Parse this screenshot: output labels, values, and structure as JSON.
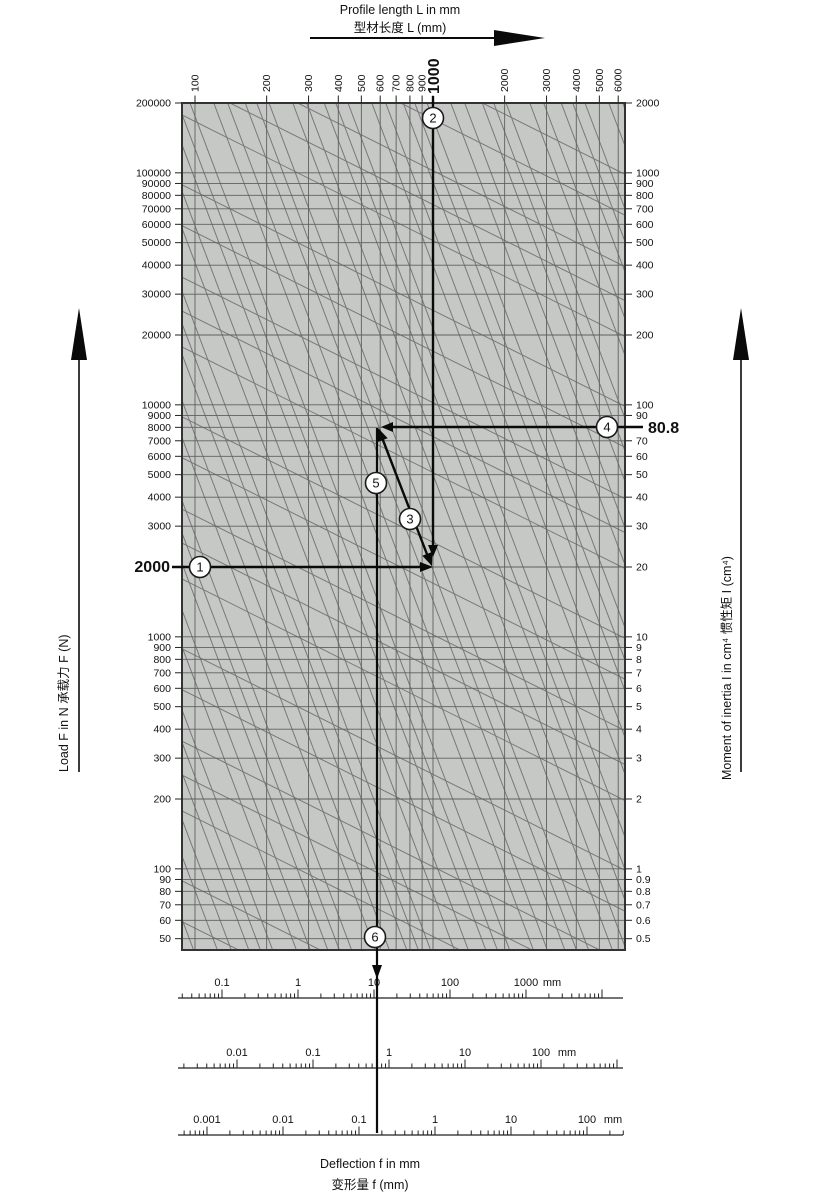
{
  "chart_data": {
    "type": "nomogram",
    "title": {
      "line1": "Profile length L in mm",
      "line2": "型材长度 L (mm)"
    },
    "x_axis": {
      "unit": "mm",
      "ticks": [
        "100",
        "200",
        "300",
        "400",
        "500",
        "600",
        "700",
        "800",
        "900",
        "1000",
        "2000",
        "3000",
        "4000",
        "5000",
        "6000"
      ],
      "bold_tick": "1000"
    },
    "left_axis": {
      "label": "Load F in N   承载力 F (N)",
      "unit": "N",
      "ticks": [
        "200000",
        "100000",
        "90000",
        "80000",
        "70000",
        "60000",
        "50000",
        "40000",
        "30000",
        "20000",
        "10000",
        "9000",
        "8000",
        "7000",
        "6000",
        "5000",
        "4000",
        "3000",
        "2000",
        "1000",
        "900",
        "800",
        "700",
        "600",
        "500",
        "400",
        "300",
        "200",
        "100",
        "90",
        "80",
        "70",
        "60",
        "50"
      ],
      "bold_tick": "2000"
    },
    "right_axis": {
      "label": "Moment of inertia I in cm⁴   惯性矩 I (cm⁴)",
      "unit": "cm⁴",
      "ticks": [
        "2000",
        "1000",
        "900",
        "800",
        "700",
        "600",
        "500",
        "400",
        "300",
        "200",
        "100",
        "90",
        "70",
        "60",
        "50",
        "40",
        "30",
        "20",
        "10",
        "9",
        "8",
        "7",
        "6",
        "5",
        "4",
        "3",
        "2",
        "1",
        "0.9",
        "0.8",
        "0.7",
        "0.6",
        "0.5"
      ],
      "bold_tick": "80.8"
    },
    "deflection_scales": [
      {
        "labels": [
          "0.1",
          "1",
          "10",
          "100",
          "1000"
        ],
        "unit": "mm"
      },
      {
        "labels": [
          "0.01",
          "0.1",
          "1",
          "10",
          "100"
        ],
        "unit": "mm"
      },
      {
        "labels": [
          "0.001",
          "0.01",
          "0.1",
          "1",
          "10",
          "100"
        ],
        "unit": "mm"
      }
    ],
    "caption": {
      "line1": "Deflection f in mm",
      "line2": "变形量 f (mm)"
    },
    "example": {
      "load": "2000",
      "length": "1000",
      "inertia": "80.8",
      "deflection": "10",
      "steps": [
        "1",
        "2",
        "3",
        "4",
        "5",
        "6"
      ]
    },
    "colors": {
      "plot_bg": "#c6c8c6",
      "grid": "#5f5f5f",
      "diagonal": "#787878",
      "border": "#333333",
      "example": "#0a0a0a"
    }
  }
}
